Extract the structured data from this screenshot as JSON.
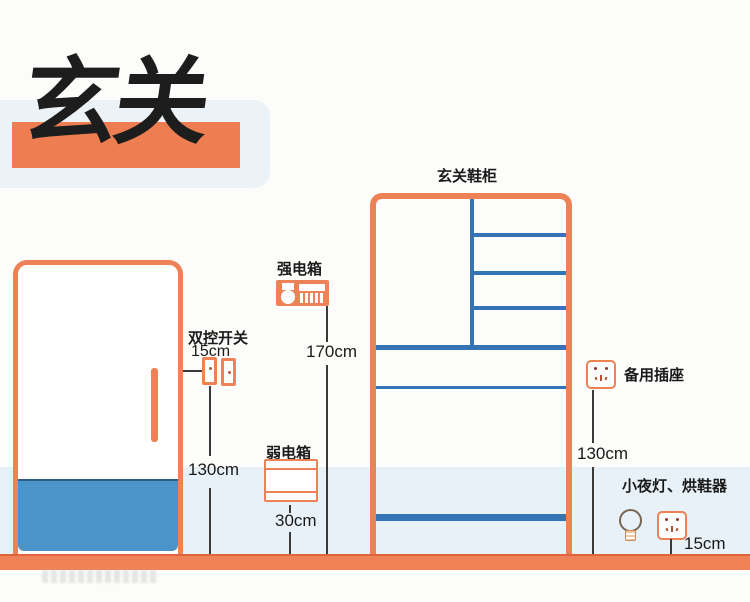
{
  "title": {
    "text": "玄关"
  },
  "cabinet": {
    "label": "玄关鞋柜"
  },
  "annotations": {
    "switch": {
      "label": "双控开关",
      "offset": "15cm",
      "height": "130cm"
    },
    "strong_box": {
      "label": "强电箱",
      "height": "170cm"
    },
    "weak_box": {
      "label": "弱电箱",
      "height": "30cm"
    },
    "spare_socket": {
      "label": "备用插座",
      "height": "130cm"
    },
    "night_light": {
      "label": "小夜灯、烘鞋器",
      "height": "15cm"
    }
  },
  "colors": {
    "accent_orange": "#ee8257",
    "floor_orange": "#ef8257",
    "panel_blue": "#4a94c9",
    "shelf_blue": "#3574b4",
    "wall_band": "#e8f1f8",
    "title_card": "#ecf3f8",
    "text": "#1a1a1a"
  }
}
